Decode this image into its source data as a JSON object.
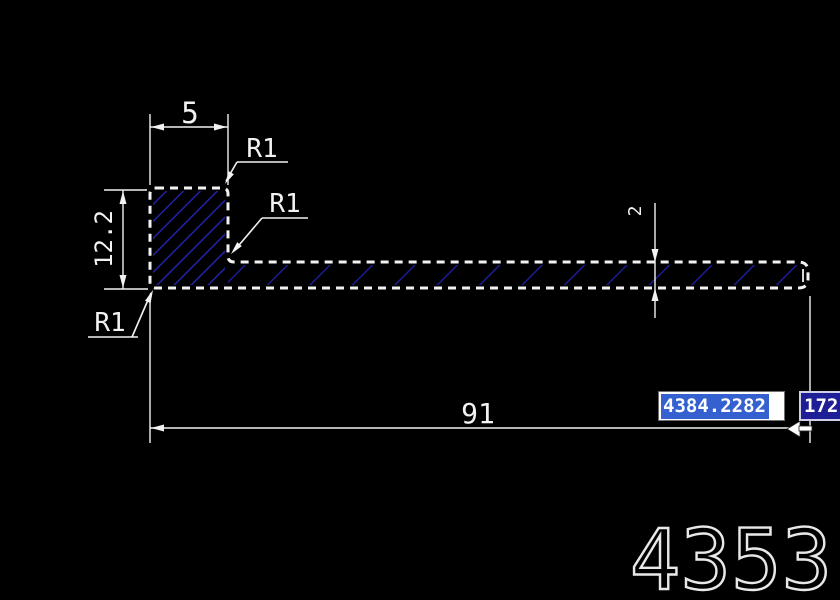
{
  "colors": {
    "background": "#000000",
    "line": "#f2f2f2",
    "hatch_leg": "#2222a6",
    "hatch_strip": "#1b1b96",
    "selection_blue": "#3461cf",
    "overflow_navy": "#1e1e96"
  },
  "dims": {
    "top_width": "5",
    "left_height": "12.2",
    "thickness": "2",
    "length": "91"
  },
  "callouts": [
    "R1",
    "R1",
    "R1"
  ],
  "editor": {
    "active_value": "4384.2282",
    "overflow_value": "172"
  },
  "title_number": "4353"
}
